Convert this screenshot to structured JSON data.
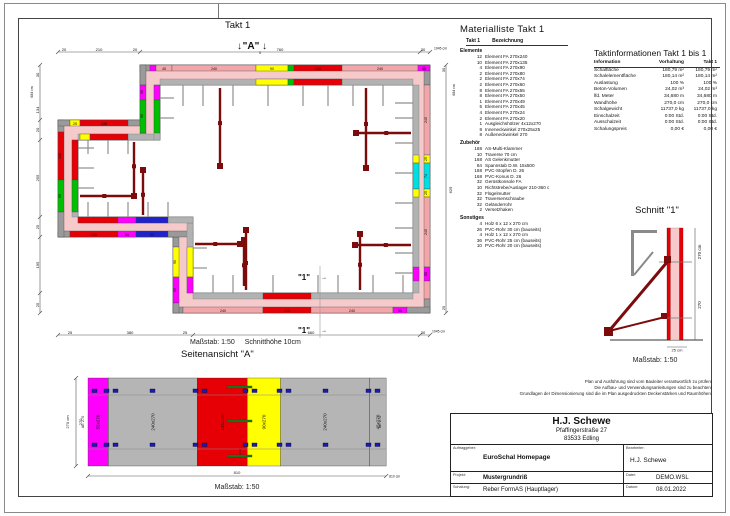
{
  "palette": {
    "pink": "#f2a6aa",
    "wall_core": "#f6c9cb",
    "red": "#e60005",
    "yellow": "#ffff00",
    "green": "#00bf00",
    "magenta": "#ff00ff",
    "blue": "#2222cc",
    "cyan": "#00e0e0",
    "gray": "#9a9a9a",
    "panelgray": "#b5b5b5",
    "darkred": "#7c0c0c",
    "clampblue": "#1a1ab4",
    "spanngreen": "#1e7a1e"
  },
  "plan": {
    "title": "Takt 1",
    "a_label": "\"A\"",
    "a_sub": "5",
    "arrow_down": "↓",
    "arrow_right": "→",
    "one_label": "\"1\"",
    "massstab": "Maßstab: 1:50",
    "schnitthoehe": "Schnitthöhe 10cm",
    "element_labels": [
      "45",
      "240",
      "90",
      "135",
      "240",
      "55",
      "240",
      "25",
      "74",
      "25",
      "240",
      "55",
      "240",
      "135",
      "240",
      "55",
      "90",
      "50",
      "135",
      "55",
      "90",
      "135",
      "90",
      "25",
      "135",
      "30",
      "90"
    ],
    "dims": {
      "top": [
        "20",
        "210",
        "20",
        "760",
        "30",
        "1045 cm"
      ],
      "left": [
        "30",
        "684 cm",
        "134",
        "20",
        "255",
        "25",
        "195",
        "25"
      ],
      "right": [
        "30",
        "684 cm",
        "629",
        "25"
      ],
      "bottom": [
        "25",
        "380",
        "25",
        "660",
        "30",
        "1045 cm"
      ]
    }
  },
  "materialliste": {
    "title": "Materialliste  Takt 1",
    "col1": "Takt 1",
    "col2": "Bezeichnung",
    "sections": [
      {
        "name": "Elemente",
        "items": [
          {
            "qty": "12",
            "name": "Element FA 270x240"
          },
          {
            "qty": "10",
            "name": "Element FA 270x135"
          },
          {
            "qty": "4",
            "name": "Element FA 270x90"
          },
          {
            "qty": "2",
            "name": "Element FA 270x80"
          },
          {
            "qty": "2",
            "name": "Element FA 270x74"
          },
          {
            "qty": "2",
            "name": "Element FA 270x60"
          },
          {
            "qty": "8",
            "name": "Element FA 270x55"
          },
          {
            "qty": "8",
            "name": "Element FA 270x50"
          },
          {
            "qty": "1",
            "name": "Element FA 270x49"
          },
          {
            "qty": "5",
            "name": "Element FA 270x45"
          },
          {
            "qty": "4",
            "name": "Element FA 270x24"
          },
          {
            "qty": "2",
            "name": "Element FA 270x20"
          },
          {
            "qty": "1",
            "name": "Ausgleichshölzer 4x12x270"
          },
          {
            "qty": "8",
            "name": "Inneneckwinkel 270x25x25"
          },
          {
            "qty": "8",
            "name": "Außeneckwinkel 270"
          }
        ]
      },
      {
        "name": "Zubehör",
        "items": [
          {
            "qty": "168",
            "name": "AS-Multi-Klammer"
          },
          {
            "qty": "10",
            "name": "Traverse 70 cm"
          },
          {
            "qty": "168",
            "name": "AS Gelenkmutter"
          },
          {
            "qty": "84",
            "name": "Spannstab D.W. 15x500"
          },
          {
            "qty": "168",
            "name": "PVC-Stopfen D. 26"
          },
          {
            "qty": "168",
            "name": "PVC-Konus D. 26"
          },
          {
            "qty": "32",
            "name": "Gerüstkonsole FA"
          },
          {
            "qty": "10",
            "name": "Richtstrebe/Auslager 210-360 c"
          },
          {
            "qty": "32",
            "name": "Flügelmutter"
          },
          {
            "qty": "32",
            "name": "Traversenschraube"
          },
          {
            "qty": "32",
            "name": "Geländerrohr"
          },
          {
            "qty": "2",
            "name": "Versetzhaken"
          }
        ]
      },
      {
        "name": "Sonstiges",
        "items": [
          {
            "qty": "4",
            "name": "Holz 6 x 12 x 270 cm"
          },
          {
            "qty": "26",
            "name": "PVC-Rohr 30 cm (bauseits)"
          },
          {
            "qty": "4",
            "name": "Holz 1 x 12 x 270 cm"
          },
          {
            "qty": "36",
            "name": "PVC-Rohr 25 cm (bauseits)"
          },
          {
            "qty": "10",
            "name": "PVC-Rohr 20 cm (bauseits)"
          }
        ]
      }
    ]
  },
  "taktinfo": {
    "title": "Taktinformationen  Takt 1 bis 1",
    "headers": [
      "Information",
      "Vorhaltung",
      "Takt 1"
    ],
    "rows": [
      [
        "Schalfläche",
        "180,79 m²",
        "180,79 m²"
      ],
      [
        "Schalelementfläche",
        "180,14 m²",
        "180,14 m²"
      ],
      [
        "Auslastung",
        "100 %",
        "100 %"
      ],
      [
        "Beton-Volumen",
        "24,02 m³",
        "24,02 m³"
      ],
      [
        "lfd. Meter",
        "34,680 m",
        "34,680 m"
      ],
      [
        "Wandhöhe",
        "270,0 cm",
        "270,0 cm"
      ],
      [
        "Schalgewicht",
        "11737,0 kg",
        "11737,0 kg"
      ],
      [
        "Einschalzeit",
        "0:00 Std.",
        "0:00 Std."
      ],
      [
        "Ausschalzeit",
        "0:00 Std.",
        "0:00 Std."
      ],
      [
        "Schalungspreis",
        "0,00 €",
        "0,00 €"
      ]
    ]
  },
  "schnitt": {
    "title": "Schnitt \"1\"",
    "dim_right_outer": "270 cm",
    "dim_right_inner": "270",
    "dim_bottom": "25 cm",
    "massstab": "Maßstab: 1:50"
  },
  "seitenansicht": {
    "title": "Seitenansicht \"A\"",
    "massstab": "Maßstab: 1:50",
    "ae_label": "AE 270",
    "filler_label": "5x270",
    "dim_left_outer": "270 cm",
    "dim_left_inner": "270",
    "dim_bottom": "810",
    "dim_bottom_right": "810 cm",
    "blocks": [
      {
        "label": "55x270",
        "w": 55,
        "color": "magenta"
      },
      {
        "label": "240x270",
        "w": 240,
        "color": "panelgray"
      },
      {
        "label": "135x270",
        "w": 135,
        "color": "red"
      },
      {
        "label": "90x270",
        "w": 90,
        "color": "yellow"
      },
      {
        "label": "240x270",
        "w": 240,
        "color": "panelgray"
      },
      {
        "label": "45x270",
        "w": 45,
        "color": "panelgray"
      }
    ]
  },
  "disclaimer": [
    "Plan und Ausführung sind vom Bauleiter verantwortlich zu prüfen!",
    "Die Aufbau- und Verwendungsanleitungen sind zu beachten!",
    "Grundlagen der Dimensionierung sind die im Plan ausgedruckten Deckenstärken und Raumhöhen."
  ],
  "titleblock": {
    "name": "H.J. Schewe",
    "addr1": "Pfaffingerstraße 27",
    "addr2": "83533 Edling",
    "auftraggeber_label": "Auftraggeber:",
    "auftraggeber": "EuroSchal Homepage",
    "bearbeiter_label": "Bearbeiter:",
    "bearbeiter": "H.J. Schewe",
    "projekt_label": "Projekt:",
    "projekt": "Mustergrundriß",
    "datei_label": "Datei:",
    "datei": "DEMO.WSL",
    "schalung_label": "Schalung:",
    "schalung": "Reber FormAS (Hauptlager)",
    "datum_label": "Datum:",
    "datum": "08.01.2022"
  }
}
